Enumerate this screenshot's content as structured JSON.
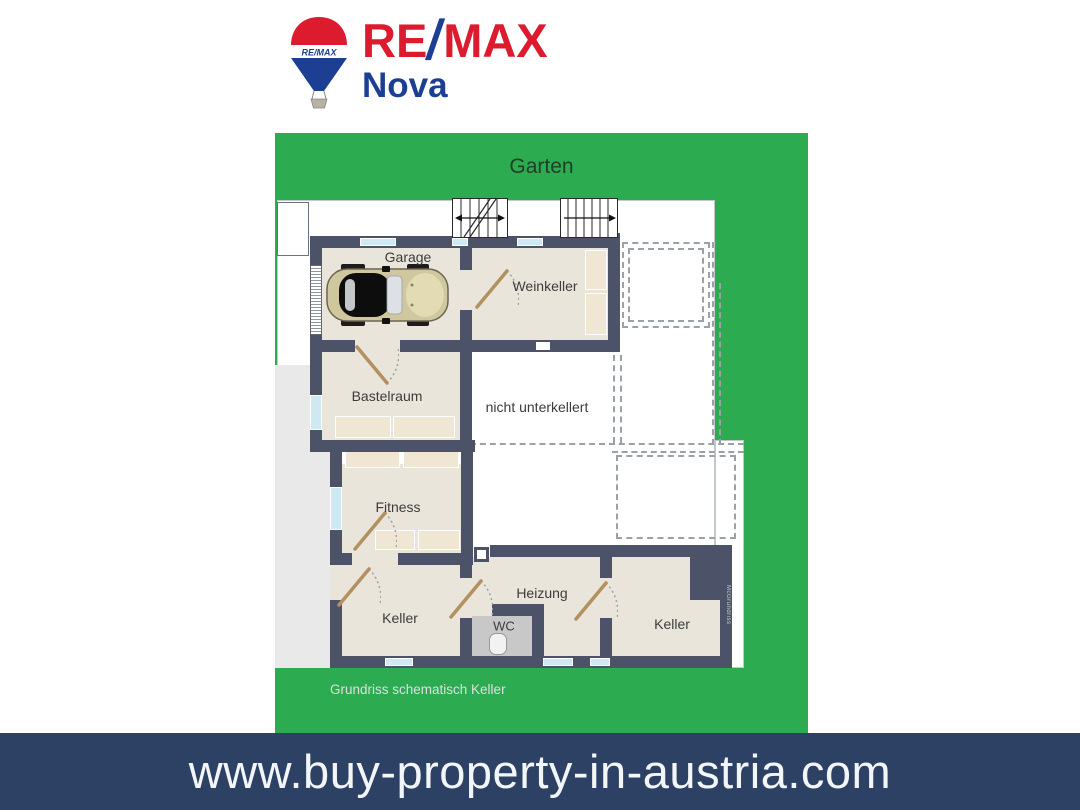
{
  "header": {
    "logo": {
      "balloon_text": "RE/MAX",
      "brand_re": "RE",
      "brand_slash": "/",
      "brand_max": "MAX",
      "office": "Nova"
    }
  },
  "garden": {
    "label": "Garten"
  },
  "plan": {
    "caption": "Grundriss schematisch Keller",
    "side_watermark": "McGrundriss",
    "rooms": [
      {
        "label": "Garage"
      },
      {
        "label": "Weinkeller"
      },
      {
        "label": "Bastelraum"
      },
      {
        "label": "nicht unterkellert"
      },
      {
        "label": "Fitness"
      },
      {
        "label": "Keller"
      },
      {
        "label": "Heizung"
      },
      {
        "label": "WC"
      },
      {
        "label": "Keller"
      }
    ]
  },
  "footer": {
    "url": "www.buy-property-in-austria.com"
  },
  "colors": {
    "garden_green": "#2CAB51",
    "wall_slate": "#4C5268",
    "floor_beige": "#EAE5DB",
    "window_blue": "#CFE9F2",
    "door_tan": "#B3905F",
    "banner_navy": "#2D4164",
    "remax_red": "#DC1C2E",
    "remax_blue": "#1C3F94"
  }
}
